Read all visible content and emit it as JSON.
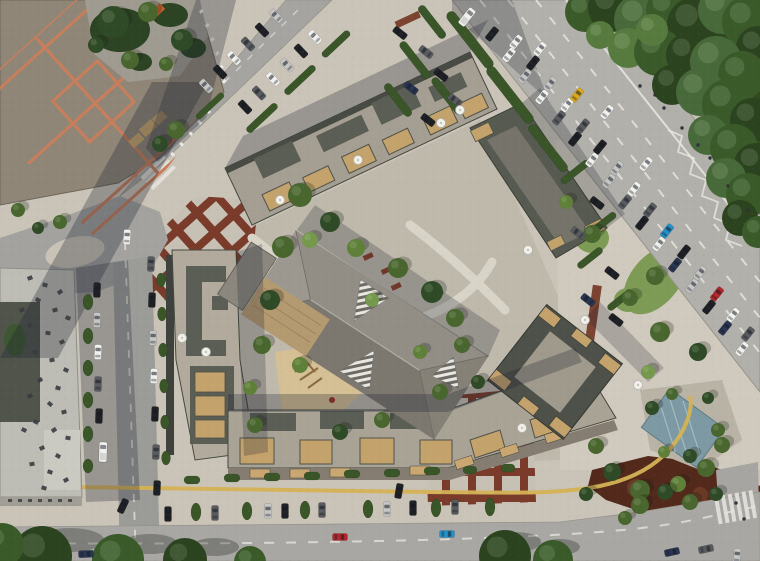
{
  "scene": {
    "title": "aerial-residential-complex-site-plan",
    "regions": [
      {
        "name": "perimeter-block-building",
        "note": "orange parapet grid roof with green courtyard, top-left"
      },
      {
        "name": "office-building",
        "note": "light flat roof with rooftop vents, left"
      },
      {
        "name": "residential-complex",
        "note": "multi-wing gravel roofs with wood terraces around green courtyard"
      },
      {
        "name": "kindergarten",
        "note": "faceted hip roof with striped skylights, center"
      },
      {
        "name": "square-tower",
        "note": "rotated square roof, lower right of complex"
      },
      {
        "name": "main-road",
        "note": "diagonal highway with queued traffic"
      },
      {
        "name": "forest",
        "note": "dense trees, top-right"
      },
      {
        "name": "pool-plaza",
        "note": "small pool, right"
      },
      {
        "name": "red-grid-plazas",
        "note": "terracotta paving bands"
      }
    ],
    "palette": {
      "ground": "#cac4b8",
      "road": "#a3a29e",
      "main_road": "#b2b0ab",
      "sidewalk": "#cdc7bb",
      "roof_light": "#a9a398",
      "roof_dark": "#565950",
      "wood": "#c3a26c",
      "orange_parapet": "#c87e5b",
      "forest": "#33491e",
      "lawn": "#7d9b55",
      "sand": "#d5bf95",
      "pool": "#7d99a3",
      "red_plaza": "#7a3b2a",
      "red_garden": "#53291b",
      "yellow_path": "#d4b255",
      "car_colors": {
        "w": "#f1f1ee",
        "s": "#c6c7c5",
        "k": "#1f2124",
        "g": "#595b5e",
        "b": "#2e6ea6",
        "t": "#2491c9",
        "db": "#2a3550",
        "r": "#b3272c",
        "y": "#d9a91f"
      },
      "tree_shades": {
        "f1": "#2b431e",
        "f2": "#3a5a2a",
        "f3": "#48693a",
        "f4": "#577a3f",
        "g1": "#2f4a26",
        "g2": "#49662f",
        "g3": "#5f8038",
        "g4": "#74984c"
      }
    },
    "cars": [
      [
        516,
        42,
        38.5,
        "w"
      ],
      [
        533,
        63,
        38.5,
        "k"
      ],
      [
        550,
        84,
        38.5,
        "s"
      ],
      [
        567,
        105,
        38.5,
        "w"
      ],
      [
        583,
        126,
        38.5,
        "g"
      ],
      [
        600,
        147,
        38.5,
        "k"
      ],
      [
        617,
        168,
        38.5,
        "s"
      ],
      [
        634,
        189,
        38.5,
        "w"
      ],
      [
        650,
        210,
        38.5,
        "g"
      ],
      [
        667,
        231,
        38.5,
        "t"
      ],
      [
        684,
        252,
        38.5,
        "k"
      ],
      [
        700,
        273,
        38.5,
        "s"
      ],
      [
        717,
        294,
        38.5,
        "r"
      ],
      [
        733,
        315,
        38.5,
        "w"
      ],
      [
        748,
        334,
        38.5,
        "g"
      ],
      [
        492,
        34,
        38.5,
        "k"
      ],
      [
        509,
        55,
        38.5,
        "w"
      ],
      [
        525,
        76,
        38.5,
        "s"
      ],
      [
        542,
        97,
        38.5,
        "w"
      ],
      [
        559,
        118,
        38.5,
        "g"
      ],
      [
        575,
        139,
        38.5,
        "k"
      ],
      [
        592,
        160,
        38.5,
        "w"
      ],
      [
        609,
        181,
        38.5,
        "s"
      ],
      [
        625,
        202,
        38.5,
        "g"
      ],
      [
        642,
        223,
        38.5,
        "k"
      ],
      [
        659,
        244,
        38.5,
        "w"
      ],
      [
        675,
        265,
        38.5,
        "db"
      ],
      [
        692,
        286,
        38.5,
        "s"
      ],
      [
        709,
        307,
        38.5,
        "k"
      ],
      [
        725,
        328,
        38.5,
        "db"
      ],
      [
        742,
        349,
        38.5,
        "w"
      ],
      [
        540,
        49,
        38.5,
        "w"
      ],
      [
        577,
        95,
        38.5,
        "y"
      ],
      [
        607,
        112,
        38.5,
        "w"
      ],
      [
        646,
        164,
        38.5,
        "w"
      ],
      [
        467,
        17,
        38.5,
        "w",
        "v"
      ],
      [
        206,
        86,
        -43.5,
        "s"
      ],
      [
        220,
        72,
        -43.5,
        "k"
      ],
      [
        234,
        58,
        -43.5,
        "w"
      ],
      [
        248,
        44,
        -43.5,
        "g"
      ],
      [
        262,
        30,
        -43.5,
        "k"
      ],
      [
        276,
        16,
        -43.5,
        "s"
      ],
      [
        245,
        107,
        -43.5,
        "k"
      ],
      [
        259,
        93,
        -43.5,
        "g"
      ],
      [
        273,
        79,
        -43.5,
        "w"
      ],
      [
        287,
        65,
        -43.5,
        "s"
      ],
      [
        301,
        51,
        -43.5,
        "k"
      ],
      [
        315,
        37,
        -43.5,
        "w"
      ],
      [
        97,
        290,
        2,
        "k"
      ],
      [
        97,
        320,
        2,
        "s"
      ],
      [
        98,
        352,
        2,
        "w"
      ],
      [
        98,
        384,
        2,
        "g"
      ],
      [
        99,
        416,
        2,
        "k"
      ],
      [
        103,
        452,
        2,
        "w",
        "v"
      ],
      [
        151,
        264,
        2,
        "g"
      ],
      [
        152,
        300,
        2,
        "k"
      ],
      [
        153,
        338,
        2,
        "s"
      ],
      [
        154,
        376,
        2,
        "w"
      ],
      [
        155,
        414,
        2,
        "k"
      ],
      [
        156,
        452,
        2,
        "g"
      ],
      [
        157,
        488,
        2,
        "k"
      ],
      [
        127,
        237,
        3,
        "w"
      ],
      [
        123,
        506,
        25,
        "k"
      ],
      [
        168,
        514,
        0,
        "k"
      ],
      [
        215,
        513,
        0,
        "g"
      ],
      [
        268,
        511,
        0,
        "s"
      ],
      [
        285,
        511,
        0,
        "k"
      ],
      [
        322,
        510,
        0,
        "g"
      ],
      [
        387,
        509,
        0,
        "s"
      ],
      [
        413,
        508,
        0,
        "k"
      ],
      [
        455,
        507,
        0,
        "g"
      ],
      [
        399,
        491,
        10,
        "k"
      ],
      [
        340,
        537,
        90,
        "r"
      ],
      [
        447,
        534,
        90,
        "t"
      ],
      [
        86,
        554,
        88,
        "db"
      ],
      [
        672,
        552,
        78,
        "db"
      ],
      [
        706,
        549,
        78,
        "g"
      ],
      [
        737,
        556,
        5,
        "s"
      ],
      [
        597,
        203,
        -52,
        "k"
      ],
      [
        578,
        233,
        -52,
        "g"
      ],
      [
        612,
        273,
        -52,
        "k"
      ],
      [
        588,
        300,
        -52,
        "db"
      ],
      [
        616,
        320,
        -52,
        "k"
      ],
      [
        400,
        33,
        -52,
        "k"
      ],
      [
        426,
        52,
        -52,
        "g"
      ],
      [
        441,
        75,
        -52,
        "k"
      ],
      [
        411,
        88,
        -52,
        "db"
      ],
      [
        455,
        100,
        -52,
        "g"
      ],
      [
        428,
        120,
        -52,
        "k"
      ]
    ],
    "trees": [
      [
        585,
        12,
        20,
        "f2"
      ],
      [
        612,
        8,
        24,
        "f1"
      ],
      [
        640,
        20,
        26,
        "f3"
      ],
      [
        668,
        10,
        22,
        "f2"
      ],
      [
        695,
        25,
        28,
        "f1"
      ],
      [
        722,
        10,
        24,
        "f3"
      ],
      [
        748,
        22,
        26,
        "f2"
      ],
      [
        758,
        48,
        22,
        "f1"
      ],
      [
        628,
        48,
        20,
        "f4"
      ],
      [
        658,
        52,
        24,
        "f2"
      ],
      [
        688,
        55,
        22,
        "f1"
      ],
      [
        716,
        62,
        26,
        "f3"
      ],
      [
        742,
        75,
        24,
        "f2"
      ],
      [
        672,
        85,
        20,
        "f1"
      ],
      [
        700,
        92,
        24,
        "f3"
      ],
      [
        728,
        105,
        26,
        "f2"
      ],
      [
        752,
        120,
        22,
        "f1"
      ],
      [
        708,
        135,
        20,
        "f3"
      ],
      [
        734,
        148,
        24,
        "f2"
      ],
      [
        756,
        165,
        22,
        "f1"
      ],
      [
        726,
        178,
        20,
        "f3"
      ],
      [
        748,
        195,
        22,
        "f2"
      ],
      [
        740,
        218,
        18,
        "f1"
      ],
      [
        758,
        232,
        16,
        "f2"
      ],
      [
        600,
        35,
        14,
        "f4"
      ],
      [
        652,
        30,
        16,
        "f4"
      ],
      [
        300,
        195,
        12,
        "g2"
      ],
      [
        330,
        222,
        10,
        "g1"
      ],
      [
        283,
        247,
        11,
        "g2"
      ],
      [
        356,
        248,
        9,
        "g3"
      ],
      [
        398,
        268,
        10,
        "g2"
      ],
      [
        432,
        292,
        11,
        "g1"
      ],
      [
        455,
        318,
        9,
        "g2"
      ],
      [
        270,
        300,
        10,
        "g1"
      ],
      [
        262,
        345,
        9,
        "g2"
      ],
      [
        300,
        365,
        8,
        "g3"
      ],
      [
        255,
        425,
        8,
        "g2"
      ],
      [
        340,
        432,
        8,
        "g1"
      ],
      [
        382,
        420,
        8,
        "g2"
      ],
      [
        420,
        352,
        7,
        "g3"
      ],
      [
        462,
        345,
        8,
        "g2"
      ],
      [
        478,
        382,
        7,
        "g1"
      ],
      [
        440,
        392,
        8,
        "g2"
      ],
      [
        250,
        388,
        7,
        "g3"
      ],
      [
        310,
        240,
        8,
        "g4"
      ],
      [
        372,
        300,
        7,
        "g4"
      ],
      [
        113,
        22,
        16,
        "g1"
      ],
      [
        148,
        12,
        10,
        "g2"
      ],
      [
        182,
        40,
        11,
        "g1"
      ],
      [
        130,
        60,
        9,
        "g2"
      ],
      [
        96,
        45,
        8,
        "g1"
      ],
      [
        166,
        64,
        7,
        "g2"
      ],
      [
        176,
        130,
        9,
        "g2"
      ],
      [
        160,
        144,
        8,
        "g1"
      ],
      [
        18,
        210,
        7,
        "g2"
      ],
      [
        60,
        222,
        7,
        "g2"
      ],
      [
        38,
        228,
        6,
        "g1"
      ],
      [
        660,
        332,
        10,
        "g2"
      ],
      [
        698,
        352,
        9,
        "g1"
      ],
      [
        596,
        446,
        8,
        "g2"
      ],
      [
        612,
        472,
        9,
        "g1"
      ],
      [
        640,
        490,
        10,
        "g2"
      ],
      [
        678,
        484,
        8,
        "g3"
      ],
      [
        706,
        468,
        9,
        "g2"
      ],
      [
        586,
        494,
        7,
        "g1"
      ],
      [
        722,
        445,
        8,
        "g2"
      ],
      [
        652,
        408,
        7,
        "g1"
      ],
      [
        672,
        394,
        6,
        "g2"
      ],
      [
        708,
        398,
        6,
        "g1"
      ],
      [
        718,
        430,
        7,
        "g2"
      ],
      [
        690,
        456,
        7,
        "g1"
      ],
      [
        664,
        452,
        6,
        "g3"
      ],
      [
        648,
        372,
        7,
        "g4"
      ],
      [
        592,
        234,
        9,
        "g2"
      ],
      [
        630,
        298,
        8,
        "g2"
      ],
      [
        566,
        202,
        7,
        "g3"
      ],
      [
        655,
        276,
        9,
        "g2"
      ],
      [
        640,
        505,
        9,
        "g2"
      ],
      [
        665,
        492,
        8,
        "g1"
      ],
      [
        690,
        502,
        8,
        "g2"
      ],
      [
        716,
        494,
        7,
        "g1"
      ],
      [
        625,
        518,
        7,
        "g2"
      ],
      [
        42,
        556,
        30,
        "f1"
      ],
      [
        118,
        560,
        26,
        "f2"
      ],
      [
        185,
        560,
        22,
        "f1"
      ],
      [
        250,
        562,
        16,
        "f2"
      ],
      [
        505,
        556,
        26,
        "f1"
      ],
      [
        553,
        560,
        20,
        "f2"
      ],
      [
        2,
        545,
        22,
        "f2"
      ]
    ],
    "hedges": [
      [
        470,
        40,
        70,
        10,
        52
      ],
      [
        510,
        95,
        70,
        10,
        52
      ],
      [
        548,
        148,
        58,
        9,
        52
      ],
      [
        415,
        60,
        45,
        8,
        52
      ],
      [
        447,
        96,
        45,
        8,
        52
      ],
      [
        398,
        100,
        40,
        8,
        52
      ],
      [
        432,
        22,
        40,
        8,
        52
      ],
      [
        575,
        172,
        34,
        7,
        -38
      ],
      [
        602,
        224,
        34,
        7,
        -38
      ],
      [
        590,
        258,
        30,
        7,
        -38
      ],
      [
        620,
        300,
        30,
        7,
        -38
      ],
      [
        88,
        302,
        10,
        16,
        0
      ],
      [
        88,
        336,
        10,
        16,
        0
      ],
      [
        88,
        368,
        10,
        16,
        0
      ],
      [
        88,
        400,
        10,
        16,
        0
      ],
      [
        88,
        434,
        10,
        16,
        0
      ],
      [
        88,
        466,
        10,
        14,
        0
      ],
      [
        161,
        280,
        9,
        14,
        0
      ],
      [
        162,
        314,
        9,
        14,
        0
      ],
      [
        163,
        350,
        9,
        14,
        0
      ],
      [
        164,
        386,
        9,
        14,
        0
      ],
      [
        165,
        422,
        9,
        14,
        0
      ],
      [
        166,
        458,
        9,
        14,
        0
      ],
      [
        192,
        480,
        16,
        8,
        0
      ],
      [
        232,
        478,
        16,
        8,
        0
      ],
      [
        272,
        477,
        16,
        8,
        0
      ],
      [
        312,
        476,
        16,
        8,
        0
      ],
      [
        352,
        474,
        16,
        8,
        0
      ],
      [
        392,
        473,
        16,
        8,
        0
      ],
      [
        432,
        471,
        16,
        8,
        0
      ],
      [
        470,
        470,
        14,
        8,
        0
      ],
      [
        508,
        468,
        14,
        8,
        0
      ],
      [
        196,
        512,
        10,
        18,
        0
      ],
      [
        247,
        511,
        10,
        18,
        0
      ],
      [
        305,
        510,
        10,
        18,
        0
      ],
      [
        368,
        509,
        10,
        18,
        0
      ],
      [
        436,
        508,
        10,
        18,
        0
      ],
      [
        490,
        507,
        10,
        18,
        0
      ],
      [
        262,
        118,
        40,
        7,
        -43
      ],
      [
        300,
        80,
        40,
        7,
        -43
      ],
      [
        336,
        44,
        36,
        7,
        -43
      ],
      [
        210,
        106,
        36,
        6,
        -43
      ]
    ],
    "vents": [
      [
        30,
        278,
        -20
      ],
      [
        45,
        285,
        15
      ],
      [
        60,
        292,
        -35
      ],
      [
        38,
        300,
        30
      ],
      [
        55,
        310,
        -15
      ],
      [
        68,
        318,
        20
      ],
      [
        30,
        325,
        -40
      ],
      [
        48,
        333,
        10
      ],
      [
        62,
        342,
        -25
      ],
      [
        35,
        352,
        35
      ],
      [
        52,
        360,
        -10
      ],
      [
        66,
        370,
        25
      ],
      [
        40,
        380,
        -30
      ],
      [
        58,
        388,
        15
      ],
      [
        30,
        396,
        -20
      ],
      [
        50,
        404,
        40
      ],
      [
        64,
        412,
        -15
      ],
      [
        36,
        422,
        25
      ],
      [
        54,
        430,
        -35
      ],
      [
        68,
        438,
        10
      ],
      [
        42,
        448,
        -25
      ],
      [
        58,
        456,
        30
      ],
      [
        32,
        464,
        -10
      ],
      [
        50,
        472,
        20
      ],
      [
        66,
        480,
        -30
      ],
      [
        44,
        488,
        15
      ],
      [
        22,
        310,
        -20
      ],
      [
        24,
        430,
        25
      ]
    ],
    "umbrellas": [
      [
        280,
        200
      ],
      [
        358,
        160
      ],
      [
        441,
        123
      ],
      [
        182,
        338
      ],
      [
        206,
        352
      ],
      [
        528,
        250
      ],
      [
        585,
        320
      ],
      [
        638,
        385
      ],
      [
        522,
        428
      ],
      [
        460,
        110
      ]
    ],
    "pedestrians": [
      [
        655,
        95
      ],
      [
        664,
        108
      ],
      [
        682,
        128
      ],
      [
        698,
        145
      ],
      [
        710,
        158
      ],
      [
        736,
        503
      ],
      [
        744,
        519
      ],
      [
        640,
        86
      ],
      [
        728,
        186
      ],
      [
        748,
        210
      ]
    ]
  }
}
